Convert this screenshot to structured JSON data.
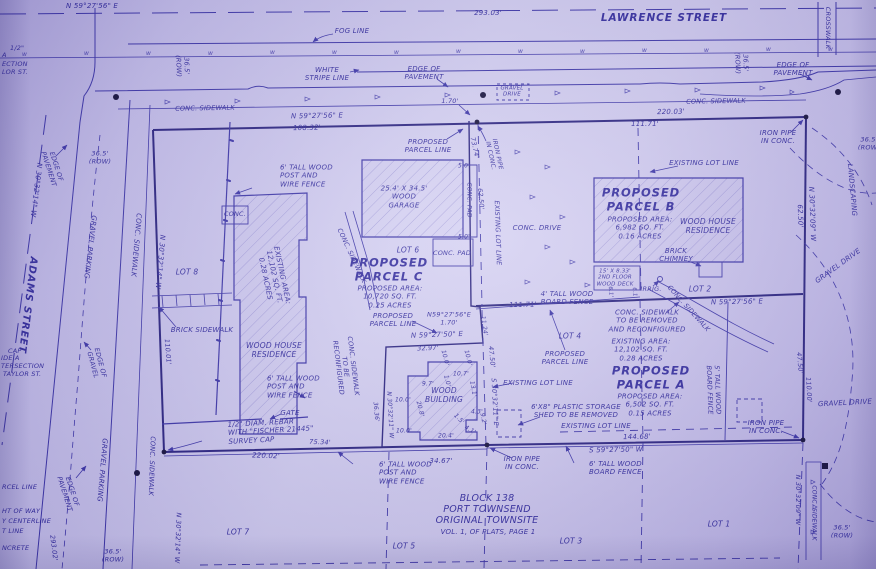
{
  "colors": {
    "paper": "#cdc7ef",
    "ink": "#3c35a8",
    "ink_bold": "#29227f",
    "text": "#332c9e",
    "dot": "#14103a"
  },
  "symbols": {
    "water_marker": "w",
    "arrow": "leader-arrow",
    "monument": "filled-circle"
  },
  "title_block": {
    "block": "BLOCK 138",
    "city": "PORT TOWNSEND",
    "townsite": "ORIGINAL TOWNSITE",
    "volume": "VOL. 1, OF PLATS, PAGE 1"
  },
  "streets": {
    "north": "LAWRENCE STREET",
    "west": "ADAMS STREET"
  },
  "parcels": [
    {
      "name": "PROPOSED PARCEL A",
      "area": "6,502 SQ. FT.",
      "acres": "0.15 ACRES",
      "existing_area": "12,102 SQ. FT.",
      "existing_acres": "0.28 ACRES"
    },
    {
      "name": "PROPOSED PARCEL B",
      "area": "6,982 SQ. FT.",
      "acres": "0.16 ACRES"
    },
    {
      "name": "PROPOSED PARCEL C",
      "area": "10,720 SQ. FT.",
      "acres": "0.25 ACRES",
      "existing_area": "12,102 SQ. FT.",
      "existing_acres": "0.28 ACRES"
    }
  ],
  "labels": [
    {
      "n": "bearing-lawrence-centerline",
      "t": "N 59°27'56\" E",
      "x": 92,
      "y": 6,
      "s": 7
    },
    {
      "n": "dim-lawrence-293",
      "t": "293.03'",
      "x": 488,
      "y": 13,
      "s": 7
    },
    {
      "n": "lawrence-street-name",
      "t": "LAWRENCE STREET",
      "x": 664,
      "y": 18,
      "s": 10.5,
      "b": 1
    },
    {
      "n": "fog-line-label",
      "t": "FOG LINE",
      "x": 352,
      "y": 31,
      "s": 7
    },
    {
      "n": "crosswalk-label",
      "t": "CROSSWALK",
      "x": 827,
      "y": 28,
      "r": 90,
      "s": 6.5
    },
    {
      "n": "cut-half-inch",
      "t": "1/2\"",
      "x": 10,
      "y": 49,
      "s": 6.5,
      "al": "l"
    },
    {
      "n": "cut-a",
      "t": "A",
      "x": 2,
      "y": 56,
      "s": 6.5,
      "al": "l"
    },
    {
      "n": "cut-ection",
      "t": "ECTION",
      "x": 2,
      "y": 65,
      "s": 6.5,
      "al": "l"
    },
    {
      "n": "cut-lor-st",
      "t": "LOR ST.",
      "x": 2,
      "y": 73,
      "s": 6.5,
      "al": "l"
    },
    {
      "n": "row-left-top",
      "t": "36.5'\n(ROW)",
      "x": 182,
      "y": 66,
      "r": 88,
      "s": 6.5
    },
    {
      "n": "white-stripe-label",
      "t": "WHITE\nSTRIPE LINE",
      "x": 327,
      "y": 74,
      "s": 7
    },
    {
      "n": "edge-pavement-top-left",
      "t": "EDGE OF\nPAVEMENT",
      "x": 424,
      "y": 73,
      "s": 7
    },
    {
      "n": "edge-pavement-top-right",
      "t": "EDGE OF\nPAVEMENT",
      "x": 793,
      "y": 69,
      "s": 7
    },
    {
      "n": "row-top-right",
      "t": "36.5'\n(ROW)",
      "x": 741,
      "y": 63,
      "r": 88,
      "s": 6.5
    },
    {
      "n": "conc-sidewalk-top-left",
      "t": "CONC. SIDEWALK",
      "x": 205,
      "y": 109,
      "r": -1,
      "s": 6.5
    },
    {
      "n": "conc-sidewalk-top-right",
      "t": "CONC. SIDEWALK",
      "x": 716,
      "y": 102,
      "r": -1,
      "s": 6.5
    },
    {
      "n": "gravel-drive-box-label",
      "t": "GRAVEL\nDRIVE",
      "x": 512,
      "y": 92,
      "s": 5.5
    },
    {
      "n": "dim-170-top",
      "t": "1.70'",
      "x": 450,
      "y": 102,
      "s": 6.5
    },
    {
      "n": "bearing-top-mid",
      "t": "N 59°27'56\" E",
      "x": 317,
      "y": 116,
      "r": -1,
      "s": 7
    },
    {
      "n": "dim-10832",
      "t": "108.32'",
      "x": 307,
      "y": 128,
      "r": -1,
      "s": 7
    },
    {
      "n": "dim-22003",
      "t": "220.03'",
      "x": 671,
      "y": 112,
      "r": -1,
      "s": 7
    },
    {
      "n": "dim-11171-top",
      "t": "111.71'",
      "x": 645,
      "y": 124,
      "s": 7
    },
    {
      "n": "iron-pipe-top-right",
      "t": "IRON PIPE\nIN CONC.",
      "x": 778,
      "y": 137,
      "s": 7
    },
    {
      "n": "proposed-parcel-line-top",
      "t": "PROPOSED\nPARCEL LINE",
      "x": 428,
      "y": 146,
      "s": 7
    },
    {
      "n": "dim-7374",
      "t": "73.74'",
      "x": 474,
      "y": 148,
      "r": 78,
      "s": 6.5
    },
    {
      "n": "iron-pipe-rotated",
      "t": "IRON PIPE\nIN CONC.",
      "x": 494,
      "y": 155,
      "r": 78,
      "s": 6
    },
    {
      "n": "dim-6250-mid",
      "t": "62.50'",
      "x": 480,
      "y": 199,
      "r": 85,
      "s": 6.5
    },
    {
      "n": "existing-lot-line-rotated",
      "t": "EXISTING LOT LINE",
      "x": 497,
      "y": 233,
      "r": 88,
      "s": 6.5
    },
    {
      "n": "garage-label",
      "t": "25.4' X 34.5'\nWOOD\nGARAGE",
      "x": 404,
      "y": 197,
      "s": 7
    },
    {
      "n": "conc-pad-rotated",
      "t": "CONC. PAD",
      "x": 469,
      "y": 200,
      "r": 90,
      "s": 6
    },
    {
      "n": "dim-50-top",
      "t": "5.0'",
      "x": 464,
      "y": 166,
      "s": 6
    },
    {
      "n": "dim-50-bottom",
      "t": "5.0'",
      "x": 464,
      "y": 237,
      "s": 6
    },
    {
      "n": "lot-6-label",
      "t": "LOT 6",
      "x": 408,
      "y": 251,
      "s": 7.5
    },
    {
      "n": "conc-pad-2-label",
      "t": "CONC. PAD",
      "x": 452,
      "y": 254,
      "s": 6.5
    },
    {
      "n": "conc-drive-label",
      "t": "CONC. DRIVE",
      "x": 537,
      "y": 228,
      "s": 7
    },
    {
      "n": "existing-lot-line-b",
      "t": "EXISTING LOT LINE",
      "x": 704,
      "y": 163,
      "s": 7
    },
    {
      "n": "parcel-b-title",
      "t": "PROPOSED\nPARCEL B",
      "x": 641,
      "y": 200,
      "s": 11.5,
      "b": 1
    },
    {
      "n": "parcel-b-area",
      "t": "PROPOSED AREA:\n6,982 SQ. FT.\n0.16 ACRES",
      "x": 640,
      "y": 228,
      "s": 7
    },
    {
      "n": "house-b-label",
      "t": "WOOD HOUSE\nRESIDENCE",
      "x": 708,
      "y": 227,
      "s": 7.5
    },
    {
      "n": "brick-chimney-label",
      "t": "BRICK\nCHIMNEY",
      "x": 676,
      "y": 255,
      "s": 7
    },
    {
      "n": "deck-label",
      "t": "15' X 8.33'\n2ND FLOOR\nWOOD DECK",
      "x": 615,
      "y": 278,
      "s": 5.5
    },
    {
      "n": "dim-61-a",
      "t": "6.1'",
      "x": 610,
      "y": 292,
      "r": 85,
      "s": 5.5
    },
    {
      "n": "dim-61-b",
      "t": "6.1'",
      "x": 634,
      "y": 293,
      "r": 85,
      "s": 5.5
    },
    {
      "n": "irrig-label",
      "t": "IRRIG.",
      "x": 651,
      "y": 290,
      "s": 6.5
    },
    {
      "n": "lot-2-label",
      "t": "LOT 2",
      "x": 700,
      "y": 290,
      "s": 7.5
    },
    {
      "n": "bearing-b-line",
      "t": "N 59°27'56\" E",
      "x": 737,
      "y": 302,
      "r": -1,
      "s": 7
    },
    {
      "n": "bearing-right-top",
      "t": "N 30°32'09\" W",
      "x": 812,
      "y": 214,
      "r": 88,
      "s": 7
    },
    {
      "n": "dim-6250-right",
      "t": "62.50'",
      "x": 800,
      "y": 216,
      "r": 88,
      "s": 7
    },
    {
      "n": "landscaping-label",
      "t": "LANDSCAPING",
      "x": 852,
      "y": 190,
      "r": 85,
      "s": 7
    },
    {
      "n": "gravel-drive-top-right",
      "t": "GRAVEL DRIVE",
      "x": 838,
      "y": 266,
      "r": -36,
      "s": 7
    },
    {
      "n": "row-right-edge",
      "t": "36.5'\n(ROW)",
      "x": 869,
      "y": 144,
      "s": 6.5
    },
    {
      "n": "conc-sidewalk-removed",
      "t": "CONC. SIDEWALK\nTO BE REMOVED\nAND RECONFIGURED",
      "x": 647,
      "y": 321,
      "s": 7
    },
    {
      "n": "conc-sidewalk-diag-right",
      "t": "CONC. SIDEWALK",
      "x": 688,
      "y": 309,
      "r": 48,
      "s": 6.5
    },
    {
      "n": "board-fence-4ft",
      "t": "4' TALL WOOD\nBOARD FENCE",
      "x": 567,
      "y": 298,
      "s": 7
    },
    {
      "n": "dim-11171-mid",
      "t": "111.71'",
      "x": 523,
      "y": 305,
      "r": -1,
      "s": 7
    },
    {
      "n": "lot-4-label",
      "t": "LOT 4",
      "x": 570,
      "y": 337,
      "s": 7.5
    },
    {
      "n": "proposed-parcel-line-mid",
      "t": "PROPOSED\nPARCEL LINE",
      "x": 565,
      "y": 358,
      "s": 7
    },
    {
      "n": "existing-lot-line-mid",
      "t": "EXISTING LOT LINE",
      "x": 538,
      "y": 383,
      "s": 7
    },
    {
      "n": "parcel-a-existing-area",
      "t": "EXISTING AREA:\n12,102 SQ. FT.\n0.28 ACRES",
      "x": 641,
      "y": 350,
      "s": 7
    },
    {
      "n": "parcel-a-title",
      "t": "PROPOSED\nPARCEL A",
      "x": 651,
      "y": 378,
      "s": 11.5,
      "b": 1
    },
    {
      "n": "parcel-a-area",
      "t": "PROPOSED AREA:\n6,502 SQ. FT.\n0.15 ACRES",
      "x": 650,
      "y": 405,
      "s": 7
    },
    {
      "n": "board-fence-5ft",
      "t": "5' TALL WOOD\nBOARD FENCE",
      "x": 713,
      "y": 390,
      "r": 88,
      "s": 6.5
    },
    {
      "n": "shed-label",
      "t": "6'X8\" PLASTIC STORAGE\nSHED TO BE REMOVED",
      "x": 576,
      "y": 411,
      "s": 7
    },
    {
      "n": "existing-lot-line-bottom-right",
      "t": "EXISTING LOT LINE",
      "x": 596,
      "y": 426,
      "s": 7
    },
    {
      "n": "bearing-bottom-right",
      "t": "S 59°27'50\" W",
      "x": 616,
      "y": 450,
      "r": -1,
      "s": 7
    },
    {
      "n": "dim-14468",
      "t": "144.68'",
      "x": 637,
      "y": 437,
      "r": -1,
      "s": 7
    },
    {
      "n": "iron-pipe-bottom-right",
      "t": "IRON PIPE\nIN CONC.",
      "x": 766,
      "y": 427,
      "s": 7
    },
    {
      "n": "dim-4750-right",
      "t": "47.50'",
      "x": 799,
      "y": 363,
      "r": 85,
      "s": 6.5
    },
    {
      "n": "dim-11000",
      "t": "110.00'",
      "x": 808,
      "y": 390,
      "r": 87,
      "s": 6.5
    },
    {
      "n": "gravel-drive-right",
      "t": "GRAVEL DRIVE",
      "x": 845,
      "y": 403,
      "r": -3,
      "s": 7
    },
    {
      "n": "lot-1-label",
      "t": "LOT 1",
      "x": 719,
      "y": 525,
      "s": 7.5
    },
    {
      "n": "bearing-bottom-right-vert",
      "t": "N 30°32'09\" W",
      "x": 797,
      "y": 500,
      "r": 90,
      "s": 6.5
    },
    {
      "n": "conc-sidewalk-bottom-right",
      "t": "CONC. SIDEWALK",
      "x": 814,
      "y": 513,
      "r": 90,
      "s": 6
    },
    {
      "n": "row-bottom-right",
      "t": "36.5'\n(ROW)",
      "x": 842,
      "y": 532,
      "s": 6.5
    },
    {
      "n": "bearing-s3032",
      "t": "S 30°32'11\" E",
      "x": 494,
      "y": 402,
      "r": 87,
      "s": 6.5
    },
    {
      "n": "dim-4750-mid",
      "t": "47.50'",
      "x": 491,
      "y": 357,
      "r": 84,
      "s": 6.5
    },
    {
      "n": "dim-1124",
      "t": "11.24'",
      "x": 484,
      "y": 326,
      "r": 82,
      "s": 6
    },
    {
      "n": "jog-bearing",
      "t": "N59°27'56\"E\n1.70'",
      "x": 449,
      "y": 319,
      "s": 6.5
    },
    {
      "n": "bearing-592750",
      "t": "N 59°27'50\" E",
      "x": 437,
      "y": 335,
      "r": -2,
      "s": 7
    },
    {
      "n": "dim-3297",
      "t": "32.97'",
      "x": 428,
      "y": 349,
      "r": -2,
      "s": 6.5
    },
    {
      "n": "proposed-parcel-line-c",
      "t": "PROPOSED\nPARCEL LINE",
      "x": 393,
      "y": 320,
      "s": 7
    },
    {
      "n": "parcel-c-title",
      "t": "PROPOSED\nPARCEL C",
      "x": 389,
      "y": 270,
      "s": 11.5,
      "b": 1
    },
    {
      "n": "parcel-c-area",
      "t": "PROPOSED AREA:\n10,720 SQ. FT.\n0.25 ACRES",
      "x": 390,
      "y": 297,
      "s": 7
    },
    {
      "n": "parcel-c-existing-area",
      "t": "EXISTING AREA:\n12,102 SQ. FT.\n0.28 ACRES",
      "x": 274,
      "y": 277,
      "r": 78,
      "s": 7
    },
    {
      "n": "house-left-label",
      "t": "WOOD HOUSE\nRESIDENCE",
      "x": 274,
      "y": 351,
      "s": 7.5
    },
    {
      "n": "wire-fence-top-left",
      "t": "6' TALL WOOD\nPOST AND\nWIRE FENCE",
      "x": 280,
      "y": 176,
      "s": 7,
      "al": "l"
    },
    {
      "n": "conc-box-label",
      "t": "CONC.",
      "x": 235,
      "y": 215,
      "s": 6.5
    },
    {
      "n": "lot-8-label",
      "t": "LOT 8",
      "x": 187,
      "y": 273,
      "s": 7.5
    },
    {
      "n": "brick-sidewalk-label",
      "t": "BRICK SIDEWALK",
      "x": 202,
      "y": 330,
      "s": 7
    },
    {
      "n": "wire-fence-mid-left",
      "t": "6' TALL WOOD\nPOST AND\nWIRE FENCE",
      "x": 267,
      "y": 387,
      "s": 7,
      "al": "l"
    },
    {
      "n": "dim-11001",
      "t": "110.01'",
      "x": 167,
      "y": 352,
      "r": 85,
      "s": 6.5
    },
    {
      "n": "row-left-mid",
      "t": "36.5'\n(ROW)",
      "x": 100,
      "y": 158,
      "s": 6.5
    },
    {
      "n": "bearing-adams-1",
      "t": "N 30°32'14\" W",
      "x": 36,
      "y": 190,
      "r": 97,
      "s": 7
    },
    {
      "n": "adams-street-name",
      "t": "ADAMS STREET",
      "x": 27,
      "y": 305,
      "r": 97,
      "s": 10,
      "b": 1
    },
    {
      "n": "edge-pavement-adams",
      "t": "EDGE OF\nPAVEMENT",
      "x": 52,
      "y": 168,
      "r": 72,
      "s": 6.5
    },
    {
      "n": "gravel-parking-1",
      "t": "GRAVEL PARKING",
      "x": 90,
      "y": 247,
      "r": 97,
      "s": 7
    },
    {
      "n": "conc-sidewalk-adams-1",
      "t": "CONC. SIDEWALK",
      "x": 136,
      "y": 245,
      "r": 95,
      "s": 7
    },
    {
      "n": "bearing-adams-2",
      "t": "N 30°32'14\" W",
      "x": 160,
      "y": 262,
      "r": 95,
      "s": 7
    },
    {
      "n": "edge-of-gravel",
      "t": "EDGE OF\nGRAVEL",
      "x": 96,
      "y": 364,
      "r": 75,
      "s": 6.5
    },
    {
      "n": "conc-sidewalk-reconfigured",
      "t": "CONC. SIDEWALK\nTO BE\nRECONFIGURED",
      "x": 345,
      "y": 367,
      "r": 83,
      "s": 6.5
    },
    {
      "n": "conc-sidewalk-diag-left",
      "t": "CONC. SIDEWALK",
      "x": 351,
      "y": 256,
      "r": 65,
      "s": 6.5
    },
    {
      "n": "wood-building-label",
      "t": "WOOD\nBUILDING",
      "x": 444,
      "y": 396,
      "s": 7.5
    },
    {
      "n": "dim-wb-100a",
      "t": "10.0'",
      "x": 445,
      "y": 358,
      "r": 75,
      "s": 6
    },
    {
      "n": "dim-wb-100b",
      "t": "10.0'",
      "x": 468,
      "y": 358,
      "r": 75,
      "s": 6
    },
    {
      "n": "dim-wb-107",
      "t": "10.7'",
      "x": 461,
      "y": 374,
      "s": 6
    },
    {
      "n": "dim-wb-10",
      "t": "1.0'",
      "x": 447,
      "y": 381,
      "r": 75,
      "s": 6
    },
    {
      "n": "dim-wb-97",
      "t": "9.7'",
      "x": 428,
      "y": 384,
      "s": 6
    },
    {
      "n": "dim-wb-131",
      "t": "13.1'",
      "x": 473,
      "y": 389,
      "r": 80,
      "s": 6
    },
    {
      "n": "dim-wb-100c",
      "t": "10.0'",
      "x": 403,
      "y": 400,
      "s": 6
    },
    {
      "n": "dim-wb-208",
      "t": "20.8'",
      "x": 420,
      "y": 409,
      "r": 75,
      "s": 6
    },
    {
      "n": "dim-wb-43",
      "t": "4.3'",
      "x": 477,
      "y": 412,
      "s": 6
    },
    {
      "n": "dim-wb-15",
      "t": "1.5'",
      "x": 459,
      "y": 419,
      "r": 45,
      "s": 6
    },
    {
      "n": "dim-wb-92",
      "t": "9.2'",
      "x": 483,
      "y": 419,
      "r": 80,
      "s": 6
    },
    {
      "n": "dim-wb-100d",
      "t": "10.0'",
      "x": 404,
      "y": 431,
      "s": 6
    },
    {
      "n": "dim-wb-204",
      "t": "20.4'",
      "x": 446,
      "y": 436,
      "s": 6
    },
    {
      "n": "dim-wb-41",
      "t": "4.1'",
      "x": 470,
      "y": 430,
      "r": 30,
      "s": 6
    },
    {
      "n": "dim-3636",
      "t": "36.36'",
      "x": 376,
      "y": 412,
      "r": 85,
      "s": 6
    },
    {
      "n": "bearing-303211w",
      "t": "N 30°32'11\" W",
      "x": 390,
      "y": 415,
      "r": 87,
      "s": 6
    },
    {
      "n": "gate-label",
      "t": "GATE",
      "x": 290,
      "y": 413,
      "s": 7
    },
    {
      "n": "rebar-label",
      "t": "1/2\" DIAM. REBAR\nWITH \"FISCHER 21445\"\nSURVEY CAP",
      "x": 228,
      "y": 431,
      "r": -3,
      "s": 7,
      "al": "l"
    },
    {
      "n": "dim-22002",
      "t": "220.02'",
      "x": 266,
      "y": 456,
      "r": 2,
      "s": 7
    },
    {
      "n": "dim-7534",
      "t": "75.34'",
      "x": 320,
      "y": 443,
      "r": 2,
      "s": 6.5
    },
    {
      "n": "dim-3467",
      "t": "34.67'",
      "x": 441,
      "y": 461,
      "s": 7
    },
    {
      "n": "wire-fence-bottom",
      "t": "6' TALL WOOD\nPOST AND\nWIRE FENCE",
      "x": 379,
      "y": 473,
      "s": 7,
      "al": "l"
    },
    {
      "n": "iron-pipe-bottom-mid",
      "t": "IRON PIPE\nIN CONC.",
      "x": 522,
      "y": 463,
      "s": 7
    },
    {
      "n": "board-fence-bottom",
      "t": "6' TALL WOOD\nBOARD FENCE",
      "x": 589,
      "y": 468,
      "s": 7,
      "al": "l"
    },
    {
      "n": "block-title",
      "t": "BLOCK 138\nPORT TOWNSEND\nORIGINAL TOWNSITE",
      "x": 487,
      "y": 510,
      "s": 9.5
    },
    {
      "n": "block-volume",
      "t": "VOL. 1, OF PLATS, PAGE 1",
      "x": 488,
      "y": 532,
      "s": 7
    },
    {
      "n": "lot-5-label",
      "t": "LOT 5",
      "x": 404,
      "y": 547,
      "s": 7.5
    },
    {
      "n": "lot-3-label",
      "t": "LOT 3",
      "x": 571,
      "y": 542,
      "s": 7.5
    },
    {
      "n": "lot-7-label",
      "t": "LOT 7",
      "x": 238,
      "y": 533,
      "s": 7.5
    },
    {
      "n": "dim-29302",
      "t": "293.02'",
      "x": 53,
      "y": 548,
      "r": 83,
      "s": 6.5
    },
    {
      "n": "bearing-bottom-left",
      "t": "N 30°32'14\" W",
      "x": 177,
      "y": 538,
      "r": 92,
      "s": 6.5
    },
    {
      "n": "conc-sidewalk-bottom-left",
      "t": "CONC. SIDEWALK",
      "x": 151,
      "y": 466,
      "r": 92,
      "s": 6.5
    },
    {
      "n": "gravel-parking-2",
      "t": "GRAVEL PARKING",
      "x": 102,
      "y": 470,
      "r": 95,
      "s": 7
    },
    {
      "n": "edge-pavement-bottom-left",
      "t": "EDGE OF\nPAVEMENT",
      "x": 68,
      "y": 493,
      "r": 72,
      "s": 6.5
    },
    {
      "n": "row-bottom-left",
      "t": "36.5'\n(ROW)",
      "x": 113,
      "y": 556,
      "s": 6.5
    },
    {
      "n": "cut-cap",
      "t": "CAP",
      "x": 8,
      "y": 352,
      "s": 6.5,
      "al": "l"
    },
    {
      "n": "cut-ide-a",
      "t": "IDE A",
      "x": 1,
      "y": 359,
      "s": 6.5,
      "al": "l"
    },
    {
      "n": "cut-tersection",
      "t": "TERSECTION",
      "x": 1,
      "y": 367,
      "s": 6.5,
      "al": "l"
    },
    {
      "n": "cut-taylor-st",
      "t": "TAYLOR ST.",
      "x": 3,
      "y": 375,
      "s": 6.5,
      "al": "l"
    },
    {
      "n": "cut-parcel-line",
      "t": "RCEL LINE",
      "x": 2,
      "y": 488,
      "s": 6.5,
      "al": "l"
    },
    {
      "n": "cut-right-of-way",
      "t": "HT OF WAY",
      "x": 2,
      "y": 512,
      "s": 6.5,
      "al": "l"
    },
    {
      "n": "cut-centerline",
      "t": "Y CENTERLINE",
      "x": 2,
      "y": 522,
      "s": 6.5,
      "al": "l"
    },
    {
      "n": "cut-lot-line",
      "t": "T LINE",
      "x": 2,
      "y": 532,
      "s": 6.5,
      "al": "l"
    },
    {
      "n": "cut-concrete",
      "t": "NCRETE",
      "x": 2,
      "y": 549,
      "s": 6.5,
      "al": "l"
    }
  ]
}
